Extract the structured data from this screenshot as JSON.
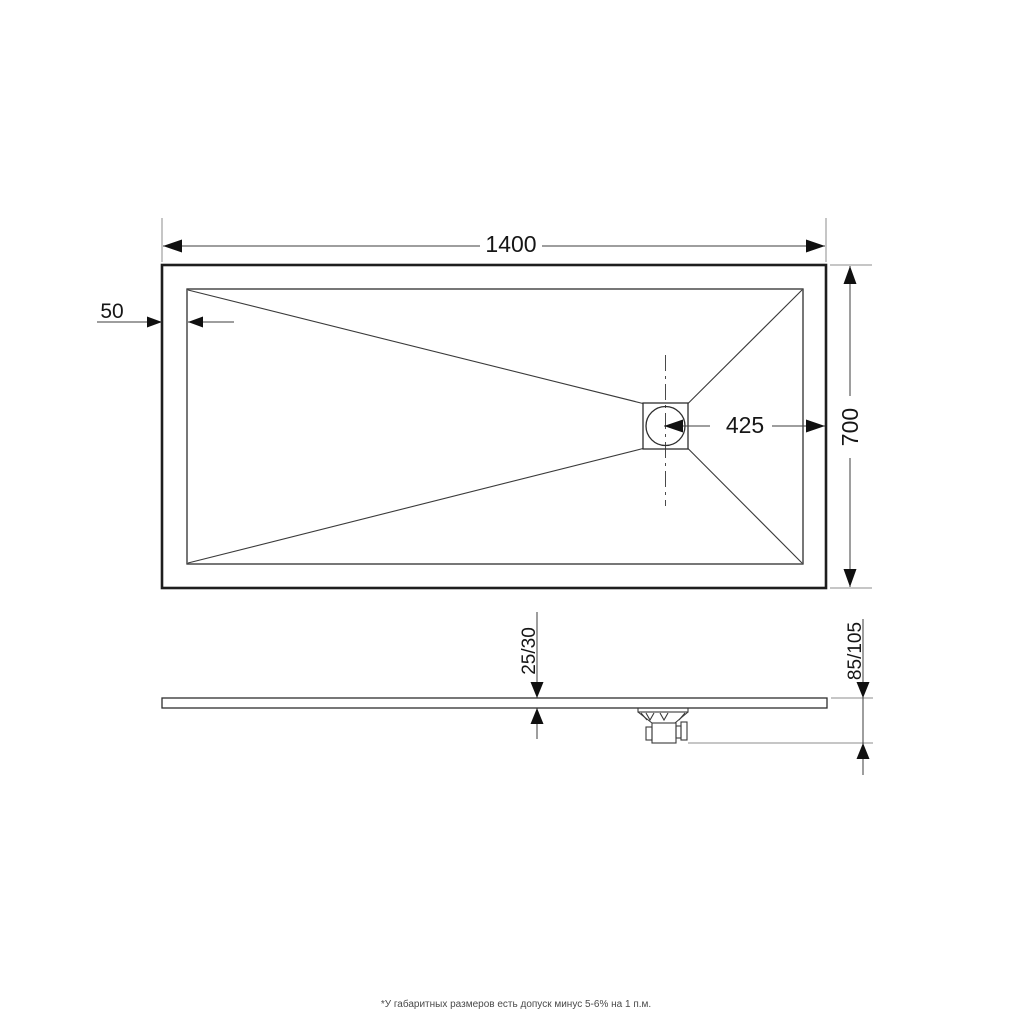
{
  "drawing": {
    "type": "shower-tray technical drawing, plan view and side profile",
    "colors": {
      "background": "#ffffff",
      "outline": "#1e1e1e",
      "dimension_lines": "#3c3c3c",
      "extension_lines": "#8e8e8e",
      "note_text": "#4a4a4a"
    },
    "plan_view": {
      "dim_length": "1400",
      "dim_border": "50",
      "dim_drain_to_edge": "425",
      "dim_width": "700"
    },
    "side_view": {
      "dim_thickness": "25/30",
      "dim_total_height": "85/105"
    },
    "footnote": "*У габаритных размеров есть допуск минус 5-6% на 1 п.м."
  }
}
